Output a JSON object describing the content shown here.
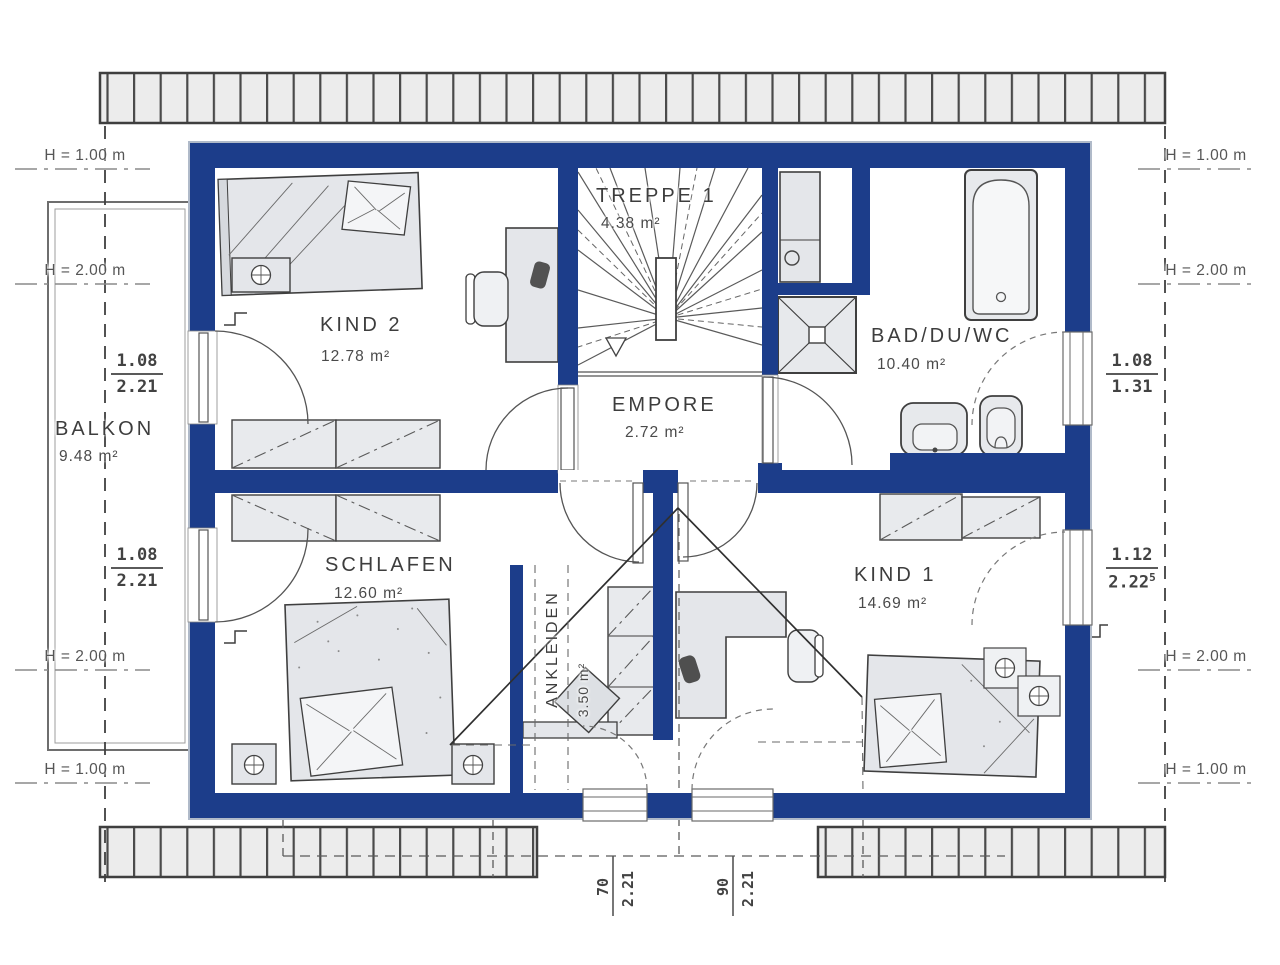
{
  "rooms": {
    "kind2": {
      "name": "KIND 2",
      "area": "12.78 m²"
    },
    "treppe1": {
      "name": "TREPPE 1",
      "area": "4.38 m²"
    },
    "bad": {
      "name": "BAD/DU/WC",
      "area": "10.40 m²"
    },
    "empore": {
      "name": "EMPORE",
      "area": "2.72 m²"
    },
    "balkon": {
      "name": "BALKON",
      "area": "9.48 m²"
    },
    "schlafen": {
      "name": "SCHLAFEN",
      "area": "12.60 m²"
    },
    "ankleiden": {
      "name": "ANKLEIDEN",
      "area": "3.50 m²"
    },
    "kind1": {
      "name": "KIND 1",
      "area": "14.69 m²"
    }
  },
  "height_markers": {
    "left": [
      "H = 1.00 m",
      "H = 2.00 m",
      "H = 2.00 m",
      "H = 1.00 m"
    ],
    "right": [
      "H = 1.00 m",
      "H = 2.00 m",
      "H = 2.00 m",
      "H = 1.00 m"
    ]
  },
  "window_dims": {
    "left_top": {
      "width": "1.08",
      "height": "2.21"
    },
    "left_bottom": {
      "width": "1.08",
      "height": "2.21"
    },
    "right_top": {
      "width": "1.08",
      "height": "1.31"
    },
    "right_bottom": {
      "width": "1.12",
      "height": "2.22",
      "height_sup": "5"
    }
  },
  "bottom_dims": [
    {
      "width": "70",
      "height": "2.21"
    },
    {
      "width": "90",
      "height": "2.21"
    }
  ],
  "colors": {
    "wall": "#1c3d8a",
    "furniture": "#e4e6ea",
    "tile": "#ececec",
    "line": "#3f3f3f"
  }
}
